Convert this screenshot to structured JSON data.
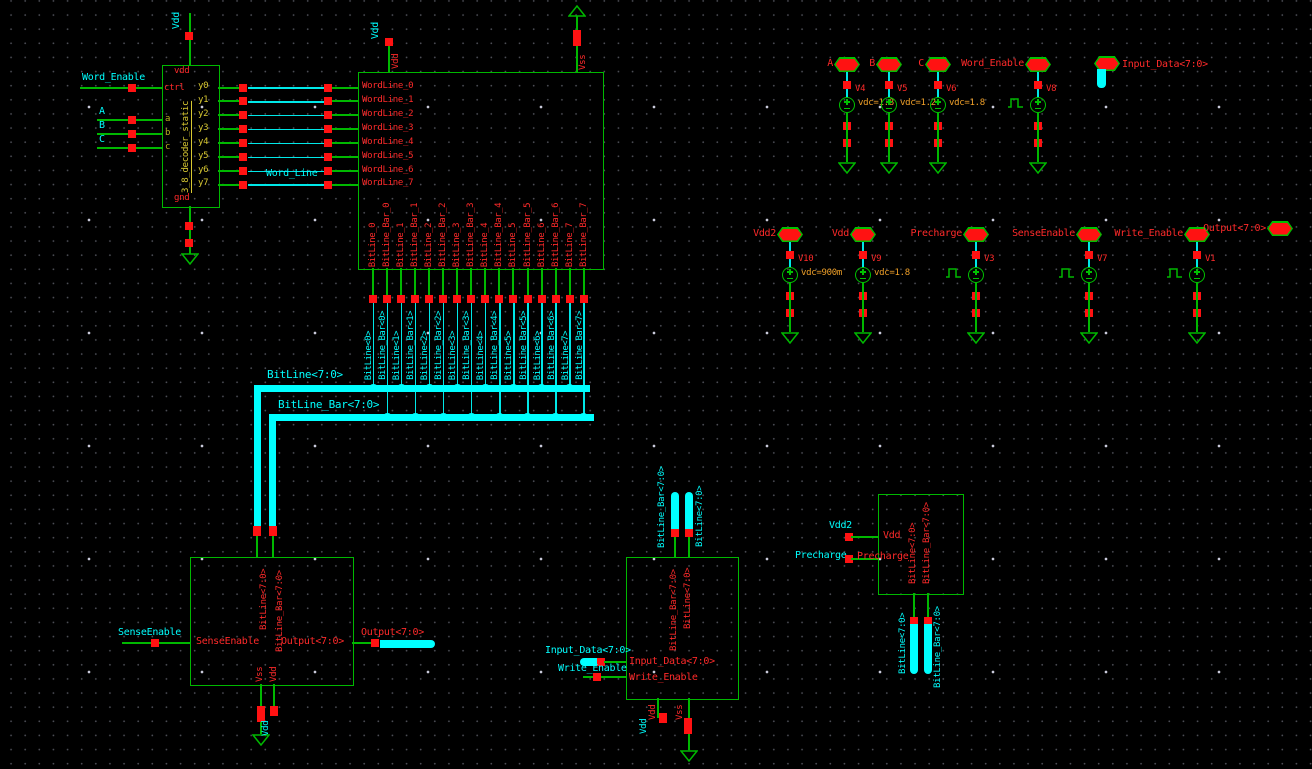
{
  "colors": {
    "wire_green": "#00b800",
    "net_cyan": "#00ffff",
    "pin_red": "#ff1212",
    "param_orange": "#f0a028",
    "id_yellow": "#d8c832",
    "background": "#000000"
  },
  "decoder": {
    "instance_label": "3_8_decoder_static",
    "vdd_pin": "vdd",
    "gnd_pin": "gnd",
    "ctrl_pin": "ctrl",
    "input_pins": [
      "a",
      "b",
      "c"
    ],
    "output_pins": [
      "y0",
      "y1",
      "y2",
      "y3",
      "y4",
      "y5",
      "y6",
      "y7"
    ],
    "vdd_net": "Vdd",
    "enable_net": "Word_Enable",
    "input_nets": [
      "A",
      "B",
      "C"
    ],
    "wordline_net": "Word_Line"
  },
  "memory_array": {
    "vdd_net": "Vdd",
    "vdd_pin": "Vdd",
    "vss_pin": "Vss",
    "wordline_pins": [
      "WordLine_0",
      "WordLine_1",
      "WordLine_2",
      "WordLine_3",
      "WordLine_4",
      "WordLine_5",
      "WordLine_6",
      "WordLine_7"
    ],
    "bitline_pins": [
      "BitLine_0",
      "BitLine_Bar_0",
      "BitLine_1",
      "BitLine_Bar_1",
      "BitLine_2",
      "BitLine_Bar_2",
      "BitLine_3",
      "BitLine_Bar_3",
      "BitLine_4",
      "BitLine_Bar_4",
      "BitLine_5",
      "BitLine_Bar_5",
      "BitLine_6",
      "BitLine_Bar_6",
      "BitLine_7",
      "BitLine_Bar_7"
    ]
  },
  "bitlines": {
    "bus_bitline": "BitLine<7:0>",
    "bus_bitline_bar": "BitLine_Bar<7:0>",
    "wire_labels": [
      "BitLine<0>",
      "BitLine_Bar<0>",
      "BitLine<1>",
      "BitLine_Bar<1>",
      "BitLine<2>",
      "BitLine_Bar<2>",
      "BitLine<3>",
      "BitLine_Bar<3>",
      "BitLine<4>",
      "BitLine_Bar<4>",
      "BitLine<5>",
      "BitLine_Bar<5>",
      "BitLine<6>",
      "BitLine_Bar<6>",
      "BitLine<7>",
      "BitLine_Bar<7>"
    ]
  },
  "sense_amp": {
    "pin_bitline": "BitLine<7:0>",
    "pin_bitline_bar": "BitLine_Bar<7:0>",
    "pin_sense_enable": "SenseEnable",
    "pin_output": "Output<7:0>",
    "pin_vss": "Vss",
    "pin_vdd": "Vdd",
    "net_sense_enable": "SenseEnable",
    "net_output": "Output<7:0>",
    "net_vdd": "Vdd"
  },
  "write_driver": {
    "pin_bitline_bar": "BitLine_Bar<7:0>",
    "pin_bitline": "BitLine<7:0>",
    "net_bitline_bar": "BitLine_Bar<7:0>",
    "net_bitline": "BitLine<7:0>",
    "pin_input_data": "Input_Data<7:0>",
    "pin_write_enable": "Write_Enable",
    "net_input_data": "Input_Data<7:0>",
    "net_write_enable": "Write_Enable",
    "pin_vdd": "Vdd",
    "pin_vss": "Vss",
    "net_vdd": "Vdd"
  },
  "precharge": {
    "pin_vdd": "Vdd",
    "pin_precharge": "Precharge",
    "net_vdd2": "Vdd2",
    "net_precharge": "Precharge",
    "pin_bitline": "BitLine<7:0>",
    "pin_bitline_bar": "BitLine_Bar<7:0>",
    "net_bitline": "BitLine<7:0>",
    "net_bitline_bar": "BitLine_Bar<7:0>"
  },
  "io_pins": {
    "input_data": "Input_Data<7:0>",
    "output": "Output<7:0>"
  },
  "sources_row1": [
    {
      "net": "A",
      "name": "V4",
      "param": "vdc=1.8",
      "type": "dc"
    },
    {
      "net": "B",
      "name": "V5",
      "param": "vdc=1.2",
      "type": "dc"
    },
    {
      "net": "C",
      "name": "V6",
      "param": "vdc=1.8",
      "type": "dc"
    },
    {
      "net": "Word_Enable",
      "name": "V8",
      "type": "pulse"
    }
  ],
  "sources_row2": [
    {
      "net": "Vdd2",
      "name": "V10",
      "param": "vdc=900m",
      "type": "dc"
    },
    {
      "net": "Vdd",
      "name": "V9",
      "param": "vdc=1.8",
      "type": "dc"
    },
    {
      "net": "Precharge",
      "name": "V3",
      "type": "pulse"
    },
    {
      "net": "SenseEnable",
      "name": "V7",
      "type": "pulse"
    },
    {
      "net": "Write_Enable",
      "name": "V1",
      "type": "pulse"
    }
  ]
}
